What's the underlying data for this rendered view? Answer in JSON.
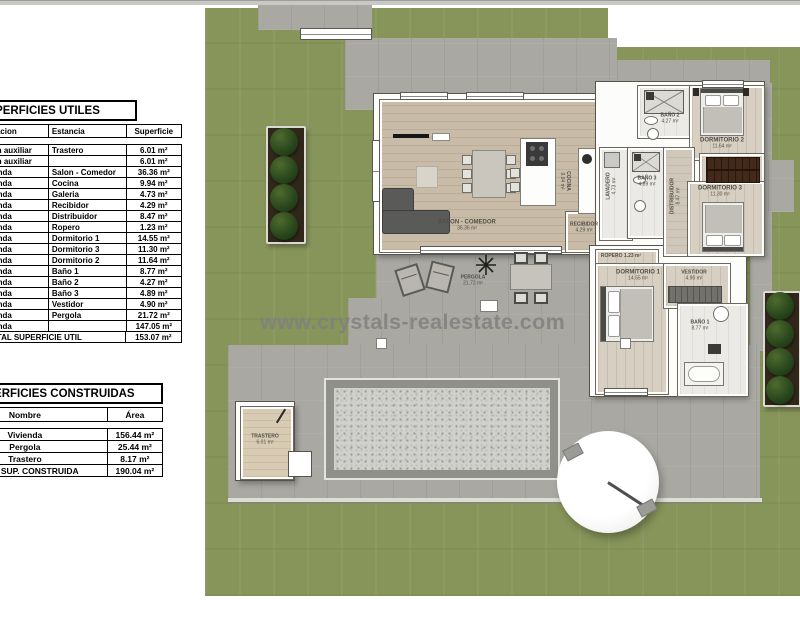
{
  "watermark": "www.crystals-realestate.com",
  "tables": {
    "utiles": {
      "title": "SUPERFICIES UTILES",
      "headers": [
        "Edificacion",
        "Estancia",
        "Superficie"
      ],
      "rows": [
        {
          "edificacion": "Edificacion auxiliar",
          "estancia": "Trastero",
          "superficie": "6.01 m²"
        },
        {
          "edificacion": "Edificacion auxiliar",
          "estancia": "",
          "superficie": "6.01 m²"
        },
        {
          "edificacion": "Vivienda",
          "estancia": "Salon - Comedor",
          "superficie": "36.36 m²"
        },
        {
          "edificacion": "Vivienda",
          "estancia": "Cocina",
          "superficie": "9.94 m²"
        },
        {
          "edificacion": "Vivienda",
          "estancia": "Galeria",
          "superficie": "4.73 m²"
        },
        {
          "edificacion": "Vivienda",
          "estancia": "Recibidor",
          "superficie": "4.29 m²"
        },
        {
          "edificacion": "Vivienda",
          "estancia": "Distribuidor",
          "superficie": "8.47 m²"
        },
        {
          "edificacion": "Vivienda",
          "estancia": "Ropero",
          "superficie": "1.23 m²"
        },
        {
          "edificacion": "Vivienda",
          "estancia": "Dormitorio 1",
          "superficie": "14.55 m²"
        },
        {
          "edificacion": "Vivienda",
          "estancia": "Dormitorio 3",
          "superficie": "11.30 m²"
        },
        {
          "edificacion": "Vivienda",
          "estancia": "Dormitorio 2",
          "superficie": "11.64 m²"
        },
        {
          "edificacion": "Vivienda",
          "estancia": "Baño 1",
          "superficie": "8.77 m²"
        },
        {
          "edificacion": "Vivienda",
          "estancia": "Baño 2",
          "superficie": "4.27 m²"
        },
        {
          "edificacion": "Vivienda",
          "estancia": "Baño 3",
          "superficie": "4.89 m²"
        },
        {
          "edificacion": "Vivienda",
          "estancia": "Vestidor",
          "superficie": "4.90 m²"
        },
        {
          "edificacion": "Vivienda",
          "estancia": "Pergola",
          "superficie": "21.72 m²"
        },
        {
          "edificacion": "Vivienda",
          "estancia": "",
          "superficie": "147.05 m²"
        }
      ],
      "total_label": "TOTAL SUPERFICIE UTIL",
      "total_value": "153.07 m²"
    },
    "construidas": {
      "title": "SUPERFICIES CONSTRUIDAS",
      "headers": [
        "Nombre",
        "Área"
      ],
      "rows": [
        {
          "nombre": "Vivienda",
          "area": "156.44 m²"
        },
        {
          "nombre": "Pergola",
          "area": "25.44 m²"
        },
        {
          "nombre": "Trastero",
          "area": "8.17 m²"
        }
      ],
      "total_label": "TOTAL SUP. CONSTRUIDA",
      "total_value": "190.04 m²"
    }
  },
  "plan": {
    "rooms": {
      "salon": {
        "name": "SALON - COMEDOR",
        "area": "36.36 m²"
      },
      "cocina": {
        "name": "COCINA",
        "area": "9.94 m²"
      },
      "recibidor": {
        "name": "RECIBIDOR",
        "area": "4.29 m²"
      },
      "lavadero": {
        "name": "LAVADERO",
        "area": "4.73 m²"
      },
      "distribuidor": {
        "name": "DISTRIBUIDOR",
        "area": "8.47 m²"
      },
      "bano1": {
        "name": "BAÑO 1",
        "area": "8.77 m²"
      },
      "bano2": {
        "name": "BAÑO 2",
        "area": "4.27 m²"
      },
      "bano3": {
        "name": "BAÑO 3",
        "area": "4.89 m²"
      },
      "dormitorio1": {
        "name": "DORMITORIO 1",
        "area": "14.55 m²"
      },
      "dormitorio2": {
        "name": "DORMITORIO 2",
        "area": "11.64 m²"
      },
      "dormitorio3": {
        "name": "DORMITORIO 3",
        "area": "11.30 m²"
      },
      "ropero": {
        "name": "ROPERO",
        "area": "1.23 m²"
      },
      "vestidor": {
        "name": "VESTIDOR",
        "area": "4.90 m²"
      },
      "pergola": {
        "name": "PERGOLA",
        "area": "21.72 m²"
      },
      "trastero": {
        "name": "TRASTERO",
        "area": "6.01 m²"
      }
    },
    "colors": {
      "lawn": "#87955a",
      "terrace": "#a9a8a3",
      "wood_floor": "#c8bca9",
      "bedroom_floor": "#d7cfc2",
      "wardrobe_brown": "#42291a",
      "pool_gravel": "#d0d0cc"
    }
  }
}
